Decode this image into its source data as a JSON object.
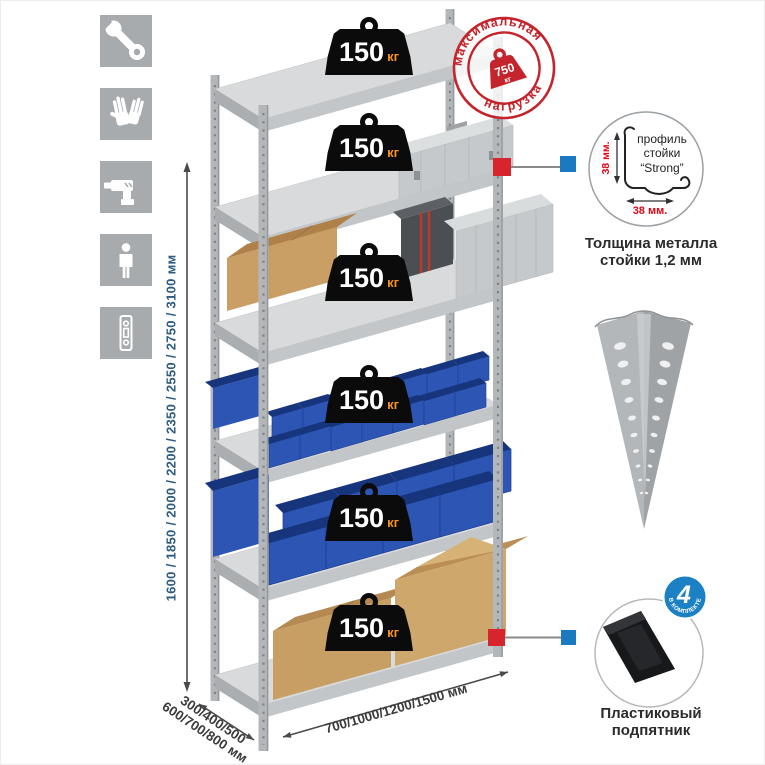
{
  "page": {
    "background": "#ffffff"
  },
  "icons_panel": {
    "items": [
      {
        "name": "wrench-icon"
      },
      {
        "name": "gloves-icon"
      },
      {
        "name": "drill-icon"
      },
      {
        "name": "person-icon"
      },
      {
        "name": "rack-post-icon"
      }
    ],
    "tile_color": "#a7abad"
  },
  "height_dimension": {
    "label": "1600 / 1850 / 2000 / 2200 / 2350 / 2550 / 2750 / 3100 мм",
    "color": "#2d5c80"
  },
  "rack": {
    "shelf_count": 6,
    "weights": [
      {
        "value": "150",
        "unit": "кг"
      },
      {
        "value": "150",
        "unit": "кг"
      },
      {
        "value": "150",
        "unit": "кг"
      },
      {
        "value": "150",
        "unit": "кг"
      },
      {
        "value": "150",
        "unit": "кг"
      },
      {
        "value": "150",
        "unit": "кг"
      }
    ],
    "bin_color": "#2c55b4",
    "metal_color": "#d8dadb"
  },
  "max_load_stamp": {
    "top_text": "максимальная",
    "bottom_text": "нагрузка",
    "weight_value": "750",
    "weight_unit": "кг",
    "color": "#c4242b"
  },
  "callouts": {
    "red_square_color": "#d8252d",
    "blue_square_color": "#1b79c0"
  },
  "profile_callout": {
    "line1": "профиль",
    "line2": "стойки",
    "line3": "“Strong”",
    "dim_vertical": "38 мм.",
    "dim_horizontal": "38 мм.",
    "dim_color": "#e30613",
    "caption_line1": "Толщина металла",
    "caption_line2": "стойки 1,2 мм"
  },
  "corner_post": {
    "name": "steel-angle-post"
  },
  "foot_callout": {
    "badge_value": "4",
    "badge_ring_text": "В КОМПЛЕКТЕ",
    "badge_color": "#1b80c4",
    "caption_line1": "Пластиковый",
    "caption_line2": "подпятник"
  },
  "depth_dimension": {
    "line1": "300/400/500",
    "line2": "600/700/800 мм"
  },
  "width_dimension": {
    "label": "700/1000/1200/1500 мм"
  }
}
